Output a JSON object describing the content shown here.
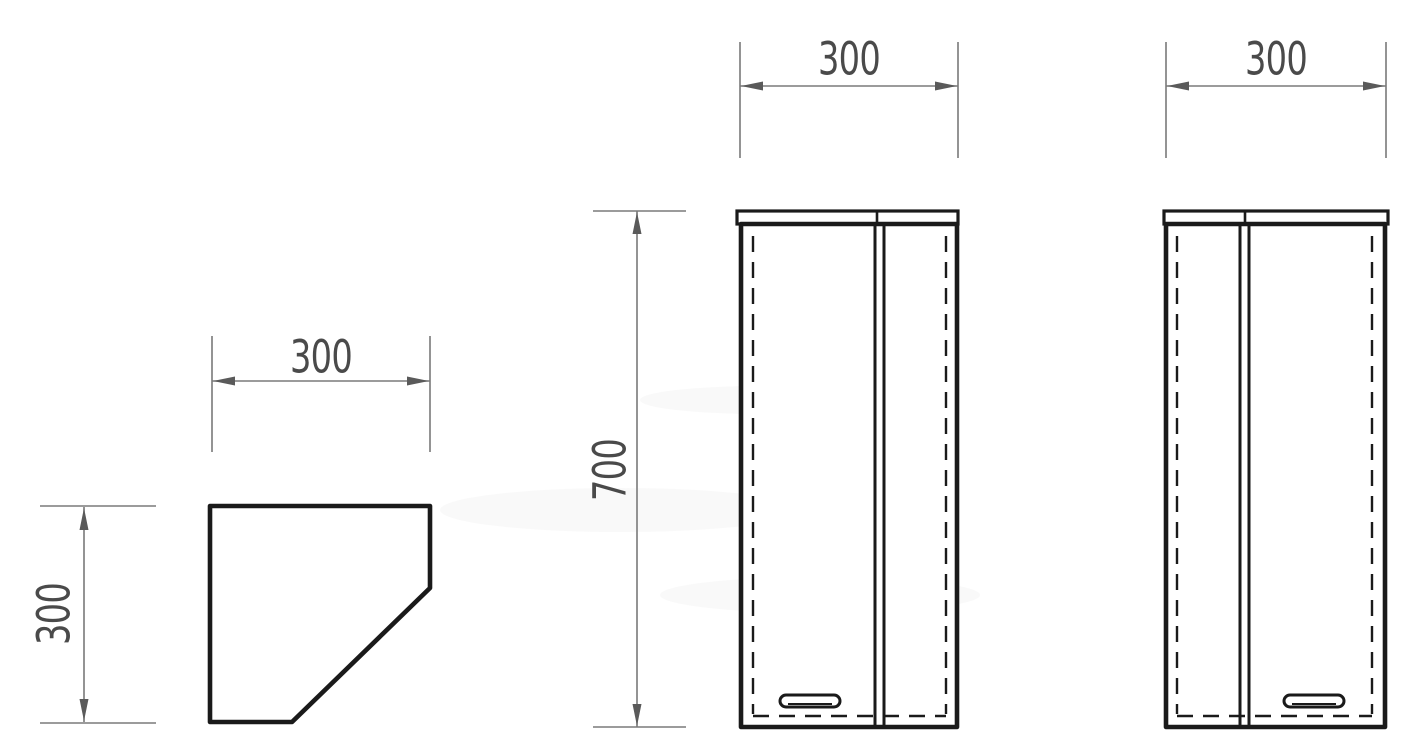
{
  "drawing": {
    "background_color": "#ffffff",
    "outline_color": "#1a1a1a",
    "dimension_line_color": "#7a7a7a",
    "label_color": "#4a4a4a"
  },
  "views": {
    "plan": {
      "width_label": "300",
      "depth_label": "300"
    },
    "front_left_door": {
      "width_label": "300",
      "height_label": "700"
    },
    "front_right_door": {
      "width_label": "300"
    }
  }
}
